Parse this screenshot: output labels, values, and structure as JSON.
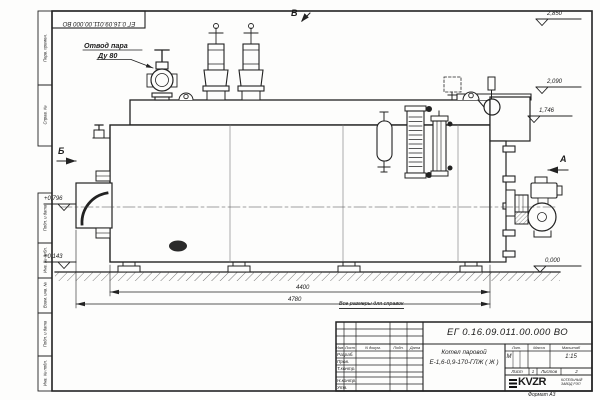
{
  "meta": {
    "doc_number": "ЕГ 0.16.09.011.00.000  ВО",
    "format_label": "Формат А3"
  },
  "annotations": {
    "steam_outlet_line1": "Отвод пара",
    "steam_outlet_line2": "Ду 80",
    "reference_note": "Все размеры для справок",
    "view_top": "В",
    "view_left": "Б",
    "view_right": "А"
  },
  "elevations": {
    "valve_top": "2,850",
    "drum_top": "2,090",
    "casing_top": "1,746",
    "burner_axis": "+0,796",
    "support": "+0,143",
    "ground": "0,000"
  },
  "dimensions": {
    "shell_length": "4400",
    "overall_length": "4780"
  },
  "title_block": {
    "doc_number": "ЕГ 0.16.09.011.00.000  ВО",
    "product_line1": "Котел паровой",
    "product_line2": "Е-1,6-0,9-170-ГЛЖ ( Ж )",
    "header_cols": [
      "Изм.",
      "Лист",
      "N докум.",
      "Подп.",
      "Дата"
    ],
    "sign_rows": [
      "Разраб.",
      "Пров.",
      "Т.контр.",
      "Н.контр.",
      "Утв."
    ],
    "lit_header": "Лит.",
    "mass_header": "Масса",
    "scale_header": "Масштаб",
    "lit_value": "М",
    "scale_value": "1:15",
    "sheet_label": "Лист",
    "sheet_value": "1",
    "sheets_label": "Листов",
    "sheets_value": "2",
    "logo_text": "KVZR",
    "company_line1": "КОТЕЛЬНЫЙ",
    "company_line2": "ЗАВОД РЭП"
  },
  "frame_strips": {
    "top": [
      "Перв. примен.",
      "Справ. №"
    ],
    "bottom": [
      "Подп. и дата",
      "Инв. № дубл.",
      "Взам. инв. №",
      "Подп. и дата",
      "Инв. № подл."
    ]
  }
}
